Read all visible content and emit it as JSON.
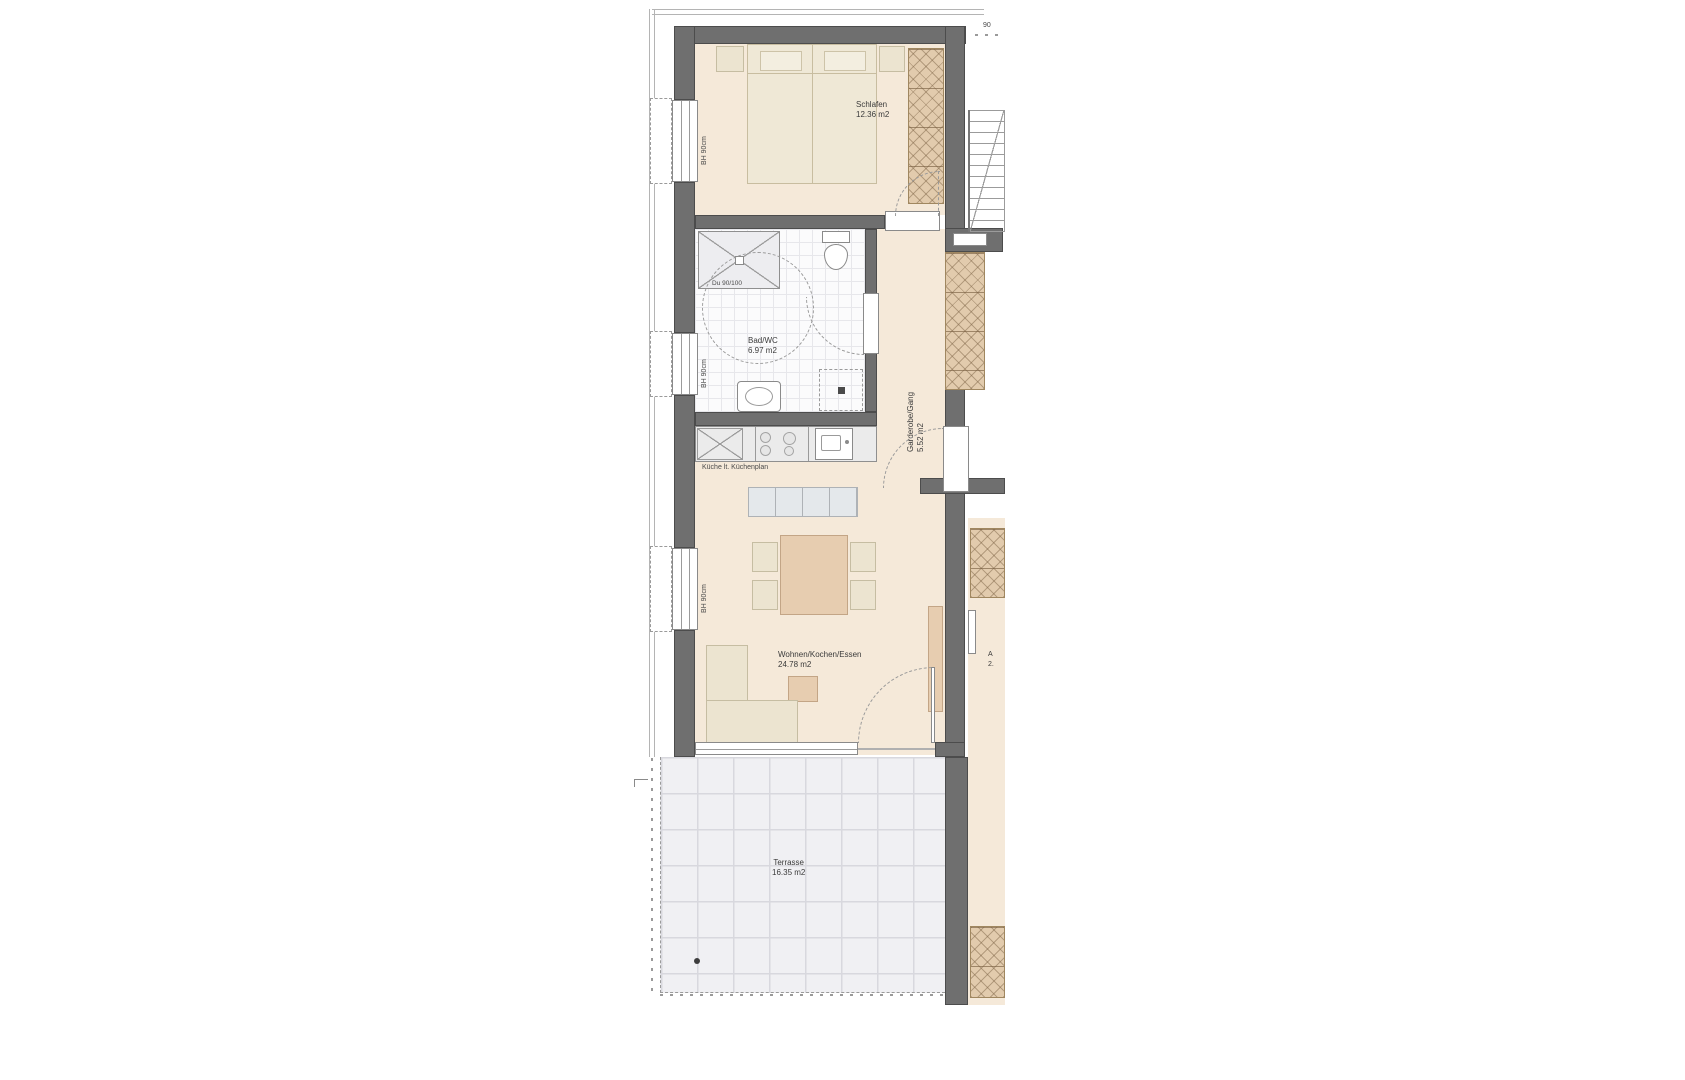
{
  "rooms": {
    "schlafen": {
      "label": "Schlafen",
      "area": "12.36 m2"
    },
    "bad": {
      "label": "Bad/WC",
      "area": "6.97 m2"
    },
    "garderobe": {
      "label": "Garderobe/Gang",
      "area": "5.52 m2"
    },
    "wohnen": {
      "label": "Wohnen/Kochen/Essen",
      "area": "24.78 m2"
    },
    "terrasse": {
      "label": "Terrasse",
      "area": "16.35 m2"
    }
  },
  "annotations": {
    "kitchen_note": "Küche lt. Küchenplan",
    "shower": "Du 90/100",
    "parapet_bedroom_window": "BH 90cm",
    "parapet_bath_window": "BH 90cm",
    "parapet_living_window": "BH 90cm",
    "dim_top_right": "90",
    "neighbor_label_fragment": "A",
    "neighbor_area_fragment": "2."
  },
  "colors": {
    "wall": "#6f6f6f",
    "room_fill": "#f5e9d9",
    "furniture_tan": "#e7cdb0",
    "furniture_cream": "#ece4d0",
    "wardrobe_hatch": "#e2cbad",
    "bath_tile": "#fbfbfc",
    "terrace_tile": "#f0f0f3",
    "kitchen_counter": "#ebebeb"
  }
}
